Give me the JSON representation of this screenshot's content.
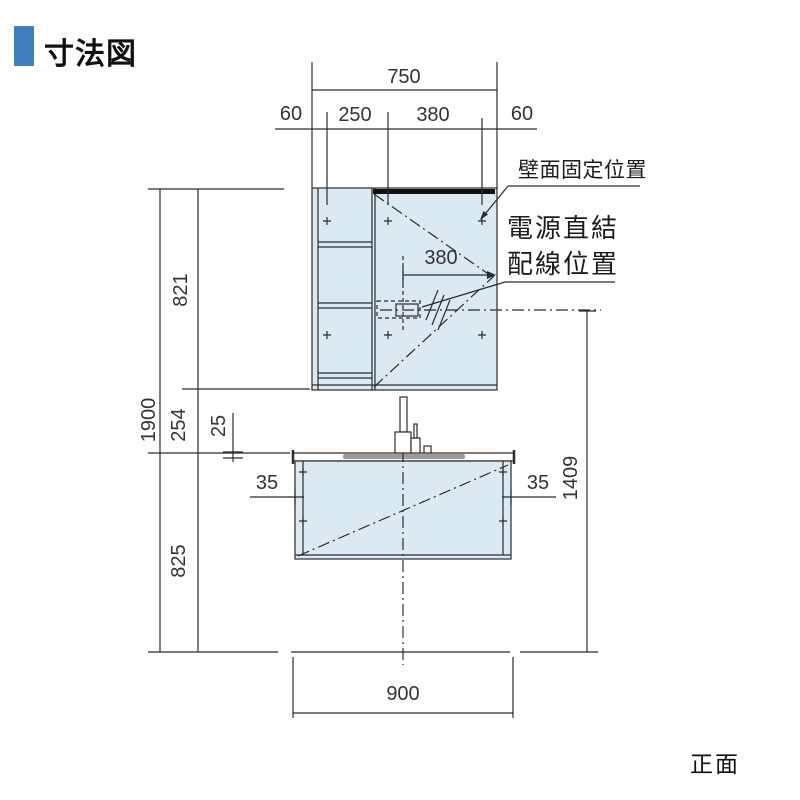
{
  "title": "寸法図",
  "footer": {
    "view_label": "正面"
  },
  "annotations": {
    "wall_fix_label": "壁面固定位置",
    "power_label_line1": "電源直結",
    "power_label_line2": "配線位置"
  },
  "dimensions": {
    "top_total": "750",
    "top_segments": [
      "60",
      "250",
      "380",
      "60"
    ],
    "wiring_offset": "380",
    "total_height": "1900",
    "upper_cabinet_height": "821",
    "mid_gap": "254",
    "counter_edge": "25",
    "lower_height": "825",
    "left_inset": "35",
    "right_inset": "35",
    "wiring_height": "1409",
    "base_width": "900"
  },
  "colors": {
    "accent_blue": "#3f7fbf",
    "cabinet_fill": "#dbe9f3",
    "basin_gray": "#9b9b9b",
    "line": "#2b2b2b"
  }
}
